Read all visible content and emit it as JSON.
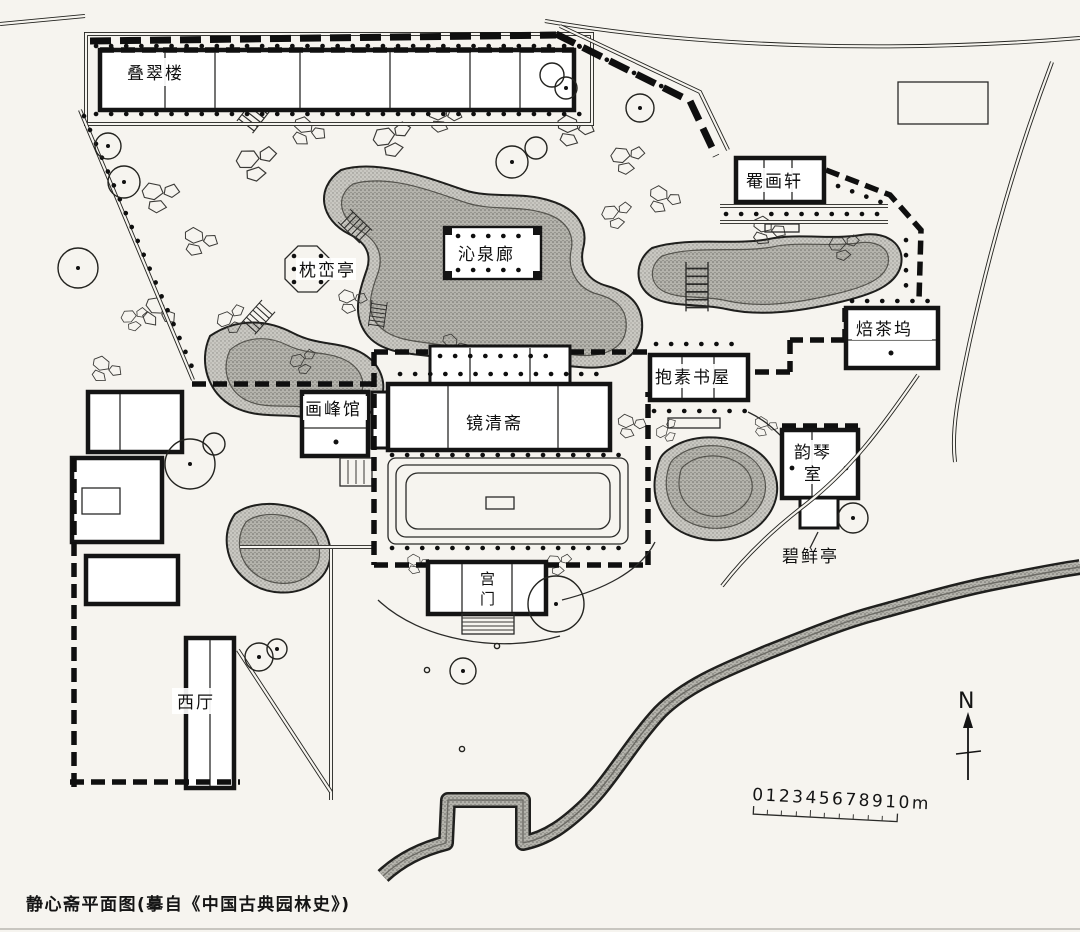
{
  "caption": "静心斋平面图(摹自《中国古典园林史》)",
  "compass": {
    "label": "N"
  },
  "scale_bar": {
    "label": "012345678910m"
  },
  "colors": {
    "paper": "#f6f4ef",
    "ink": "#141414",
    "water": "#c6c5bf",
    "water_dark": "#aeada6"
  },
  "labels": {
    "die_cui_lou": "叠翠楼",
    "yan_hua_xuan": "罨画轩",
    "qin_quan_lang": "沁泉廊",
    "zhen_luan_ting": "枕峦亭",
    "bei_cha_wu": "焙茶坞",
    "bao_su_shu_wu": "抱素书屋",
    "hua_feng_guan": "画峰馆",
    "jing_qing_zhai": "镜清斋",
    "yun_qin_shi_lines": [
      "韵琴",
      "室"
    ],
    "bi_xian_ting": "碧鲜亭",
    "gong_men": "宫门",
    "xi_ting": "西厅"
  }
}
